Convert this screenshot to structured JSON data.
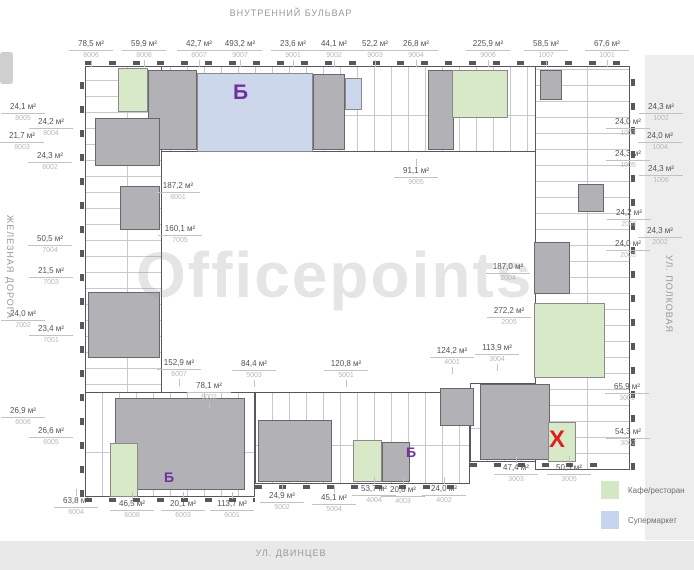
{
  "streets": {
    "top": "ВНУТРЕННИЙ БУЛЬВАР",
    "bottom": "УЛ. ДВИНЦЕВ",
    "left": "ЖЕЛЕЗНАЯ ДОРОГА",
    "right": "УЛ. ПОЛКОВАЯ"
  },
  "watermark": "Officepoints",
  "legend": {
    "items": [
      {
        "label": "Кафе/ресторан",
        "color": "#d4e7c4"
      },
      {
        "label": "Супермаркет",
        "color": "#c6d4f0"
      }
    ]
  },
  "colors": {
    "cafe": "#d8e9c8",
    "supermarket": "#ccd7ec",
    "wall": "#58585c",
    "core": "#b2b2b6",
    "marker_purple": "#7030a0",
    "marker_red": "#e01f1f"
  },
  "markers": [
    {
      "text": "Б",
      "x": 233,
      "y": 82,
      "size": 21,
      "kind": "supermarket"
    },
    {
      "text": "Б",
      "x": 164,
      "y": 470,
      "size": 14,
      "kind": "supermarket"
    },
    {
      "text": "Б",
      "x": 406,
      "y": 445,
      "size": 14,
      "kind": "supermarket"
    },
    {
      "text": "Х",
      "x": 549,
      "y": 428,
      "size": 24,
      "kind": "x"
    }
  ],
  "units": [
    {
      "a": "78,5 м²",
      "c": "8006",
      "x": 69,
      "y": 39,
      "side": "top"
    },
    {
      "a": "59,9 м²",
      "c": "8008",
      "x": 122,
      "y": 39,
      "side": "top"
    },
    {
      "a": "42,7 м²",
      "c": "8007",
      "x": 177,
      "y": 39,
      "side": "top"
    },
    {
      "a": "493,2 м²",
      "c": "9007",
      "x": 218,
      "y": 39,
      "side": "top"
    },
    {
      "a": "23,6 м²",
      "c": "9001",
      "x": 271,
      "y": 39,
      "side": "top"
    },
    {
      "a": "44,1 м²",
      "c": "9002",
      "x": 312,
      "y": 39,
      "side": "top"
    },
    {
      "a": "52,2 м²",
      "c": "9003",
      "x": 353,
      "y": 39,
      "side": "top"
    },
    {
      "a": "26,8 м²",
      "c": "9004",
      "x": 394,
      "y": 39,
      "side": "top"
    },
    {
      "a": "225,9 м²",
      "c": "9006",
      "x": 466,
      "y": 39,
      "side": "top"
    },
    {
      "a": "58,5 м²",
      "c": "1007",
      "x": 524,
      "y": 39,
      "side": "top"
    },
    {
      "a": "67,6 м²",
      "c": "1001",
      "x": 585,
      "y": 39,
      "side": "top"
    },
    {
      "a": "24,1 м²",
      "c": "8005",
      "x": 1,
      "y": 102,
      "side": "left"
    },
    {
      "a": "24,2 м²",
      "c": "8004",
      "x": 29,
      "y": 117,
      "side": "left"
    },
    {
      "a": "21,7 м²",
      "c": "8003",
      "x": 0,
      "y": 131,
      "side": "left"
    },
    {
      "a": "24,3 м²",
      "c": "8002",
      "x": 28,
      "y": 151,
      "side": "left"
    },
    {
      "a": "50,5 м²",
      "c": "7004",
      "x": 28,
      "y": 234,
      "side": "left"
    },
    {
      "a": "21,5 м²",
      "c": "7003",
      "x": 29,
      "y": 266,
      "side": "left"
    },
    {
      "a": "24,0 м²",
      "c": "7002",
      "x": 1,
      "y": 309,
      "side": "left"
    },
    {
      "a": "23,4 м²",
      "c": "7001",
      "x": 29,
      "y": 324,
      "side": "left"
    },
    {
      "a": "26,9 м²",
      "c": "6006",
      "x": 1,
      "y": 406,
      "side": "left"
    },
    {
      "a": "26,6 м²",
      "c": "6005",
      "x": 29,
      "y": 426,
      "side": "left"
    },
    {
      "a": "187,2 м²",
      "c": "8001",
      "x": 156,
      "y": 181,
      "side": "inner"
    },
    {
      "a": "160,1 м²",
      "c": "7005",
      "x": 158,
      "y": 224,
      "side": "inner"
    },
    {
      "a": "91,1 м²",
      "c": "9005",
      "x": 394,
      "y": 166,
      "side": "bottom"
    },
    {
      "a": "152,9 м²",
      "c": "6007",
      "x": 157,
      "y": 358,
      "side": "top"
    },
    {
      "a": "78,1 м²",
      "c": "6002",
      "x": 187,
      "y": 381,
      "side": "top"
    },
    {
      "a": "84,4 м²",
      "c": "5003",
      "x": 232,
      "y": 359,
      "side": "top"
    },
    {
      "a": "120,8 м²",
      "c": "5001",
      "x": 324,
      "y": 359,
      "side": "top"
    },
    {
      "a": "124,2 м²",
      "c": "4001",
      "x": 430,
      "y": 346,
      "side": "top"
    },
    {
      "a": "113,9 м²",
      "c": "3004",
      "x": 475,
      "y": 343,
      "side": "top"
    },
    {
      "a": "63,8 м²",
      "c": "6004",
      "x": 54,
      "y": 496,
      "side": "bottom"
    },
    {
      "a": "46,5 м²",
      "c": "6008",
      "x": 110,
      "y": 499,
      "side": "bottom"
    },
    {
      "a": "20,1 м²",
      "c": "6003",
      "x": 161,
      "y": 499,
      "side": "bottom"
    },
    {
      "a": "113,7 м²",
      "c": "6001",
      "x": 210,
      "y": 499,
      "side": "bottom"
    },
    {
      "a": "24,9 м²",
      "c": "5002",
      "x": 260,
      "y": 491,
      "side": "bottom"
    },
    {
      "a": "45,1 м²",
      "c": "5004",
      "x": 312,
      "y": 493,
      "side": "bottom"
    },
    {
      "a": "53,7 м²",
      "c": "4004",
      "x": 352,
      "y": 484,
      "side": "bottom"
    },
    {
      "a": "20,8 м²",
      "c": "4003",
      "x": 381,
      "y": 485,
      "side": "bottom"
    },
    {
      "a": "24,0 м²",
      "c": "4002",
      "x": 422,
      "y": 484,
      "side": "bottom"
    },
    {
      "a": "47,4 м²",
      "c": "3003",
      "x": 494,
      "y": 463,
      "side": "bottom"
    },
    {
      "a": "50,3 м²",
      "c": "3005",
      "x": 547,
      "y": 463,
      "side": "bottom"
    },
    {
      "a": "65,9 м²",
      "c": "3001",
      "x": 605,
      "y": 382,
      "side": "right"
    },
    {
      "a": "54,3 м²",
      "c": "3002",
      "x": 606,
      "y": 427,
      "side": "right"
    },
    {
      "a": "24,3 м²",
      "c": "1002",
      "x": 639,
      "y": 102,
      "side": "right"
    },
    {
      "a": "24,0 м²",
      "c": "1003",
      "x": 606,
      "y": 117,
      "side": "right"
    },
    {
      "a": "24,0 м²",
      "c": "1004",
      "x": 638,
      "y": 131,
      "side": "right"
    },
    {
      "a": "24,3 м²",
      "c": "1005",
      "x": 606,
      "y": 149,
      "side": "right"
    },
    {
      "a": "24,3 м²",
      "c": "1006",
      "x": 639,
      "y": 164,
      "side": "right"
    },
    {
      "a": "24,2 м²",
      "c": "2001",
      "x": 607,
      "y": 208,
      "side": "right"
    },
    {
      "a": "24,3 м²",
      "c": "2002",
      "x": 638,
      "y": 226,
      "side": "right"
    },
    {
      "a": "24,0 м²",
      "c": "2003",
      "x": 606,
      "y": 239,
      "side": "right"
    },
    {
      "a": "187,0 м²",
      "c": "2004",
      "x": 486,
      "y": 262,
      "side": "inner"
    },
    {
      "a": "272,2 м²",
      "c": "2005",
      "x": 487,
      "y": 306,
      "side": "inner"
    }
  ],
  "plan": {
    "bars": [
      {
        "x": 85,
        "y": 66,
        "w": 545,
        "h": 86,
        "o": "h"
      },
      {
        "x": 85,
        "y": 66,
        "w": 77,
        "h": 431,
        "o": "v"
      },
      {
        "x": 85,
        "y": 392,
        "w": 170,
        "h": 105,
        "o": "h"
      },
      {
        "x": 255,
        "y": 392,
        "w": 215,
        "h": 92,
        "o": "h"
      },
      {
        "x": 470,
        "y": 383,
        "w": 135,
        "h": 79,
        "o": "h"
      },
      {
        "x": 535,
        "y": 66,
        "w": 95,
        "h": 404,
        "o": "v"
      }
    ],
    "notches": [
      {
        "x": 85,
        "y": 61,
        "w": 545,
        "h": 4,
        "o": "h"
      },
      {
        "x": 80,
        "y": 66,
        "w": 4,
        "h": 431,
        "o": "v"
      },
      {
        "x": 85,
        "y": 498,
        "w": 170,
        "h": 4,
        "o": "h"
      },
      {
        "x": 255,
        "y": 485,
        "w": 215,
        "h": 4,
        "o": "h"
      },
      {
        "x": 470,
        "y": 463,
        "w": 135,
        "h": 4,
        "o": "h"
      },
      {
        "x": 631,
        "y": 66,
        "w": 4,
        "h": 404,
        "o": "v"
      }
    ],
    "cores": [
      {
        "x": 148,
        "y": 70,
        "w": 49,
        "h": 80
      },
      {
        "x": 313,
        "y": 74,
        "w": 32,
        "h": 76
      },
      {
        "x": 428,
        "y": 70,
        "w": 26,
        "h": 80
      },
      {
        "x": 540,
        "y": 70,
        "w": 22,
        "h": 30
      },
      {
        "x": 95,
        "y": 118,
        "w": 65,
        "h": 48
      },
      {
        "x": 120,
        "y": 186,
        "w": 40,
        "h": 44
      },
      {
        "x": 88,
        "y": 292,
        "w": 72,
        "h": 66
      },
      {
        "x": 115,
        "y": 398,
        "w": 130,
        "h": 92
      },
      {
        "x": 258,
        "y": 420,
        "w": 74,
        "h": 62
      },
      {
        "x": 382,
        "y": 442,
        "w": 28,
        "h": 40
      },
      {
        "x": 440,
        "y": 388,
        "w": 34,
        "h": 38
      },
      {
        "x": 480,
        "y": 384,
        "w": 70,
        "h": 76
      },
      {
        "x": 578,
        "y": 184,
        "w": 26,
        "h": 28
      },
      {
        "x": 534,
        "y": 242,
        "w": 36,
        "h": 52
      }
    ],
    "rooms": [
      {
        "x": 118,
        "y": 68,
        "w": 30,
        "h": 44,
        "t": "cafe"
      },
      {
        "x": 197,
        "y": 73,
        "w": 116,
        "h": 79,
        "t": "supermarket"
      },
      {
        "x": 345,
        "y": 78,
        "w": 17,
        "h": 32,
        "t": "supermarket"
      },
      {
        "x": 452,
        "y": 70,
        "w": 56,
        "h": 48,
        "t": "cafe"
      },
      {
        "x": 534,
        "y": 303,
        "w": 71,
        "h": 75,
        "t": "cafe"
      },
      {
        "x": 110,
        "y": 443,
        "w": 28,
        "h": 54,
        "t": "cafe"
      },
      {
        "x": 353,
        "y": 440,
        "w": 29,
        "h": 42,
        "t": "cafe"
      },
      {
        "x": 548,
        "y": 422,
        "w": 28,
        "h": 40,
        "t": "cafe"
      }
    ]
  }
}
